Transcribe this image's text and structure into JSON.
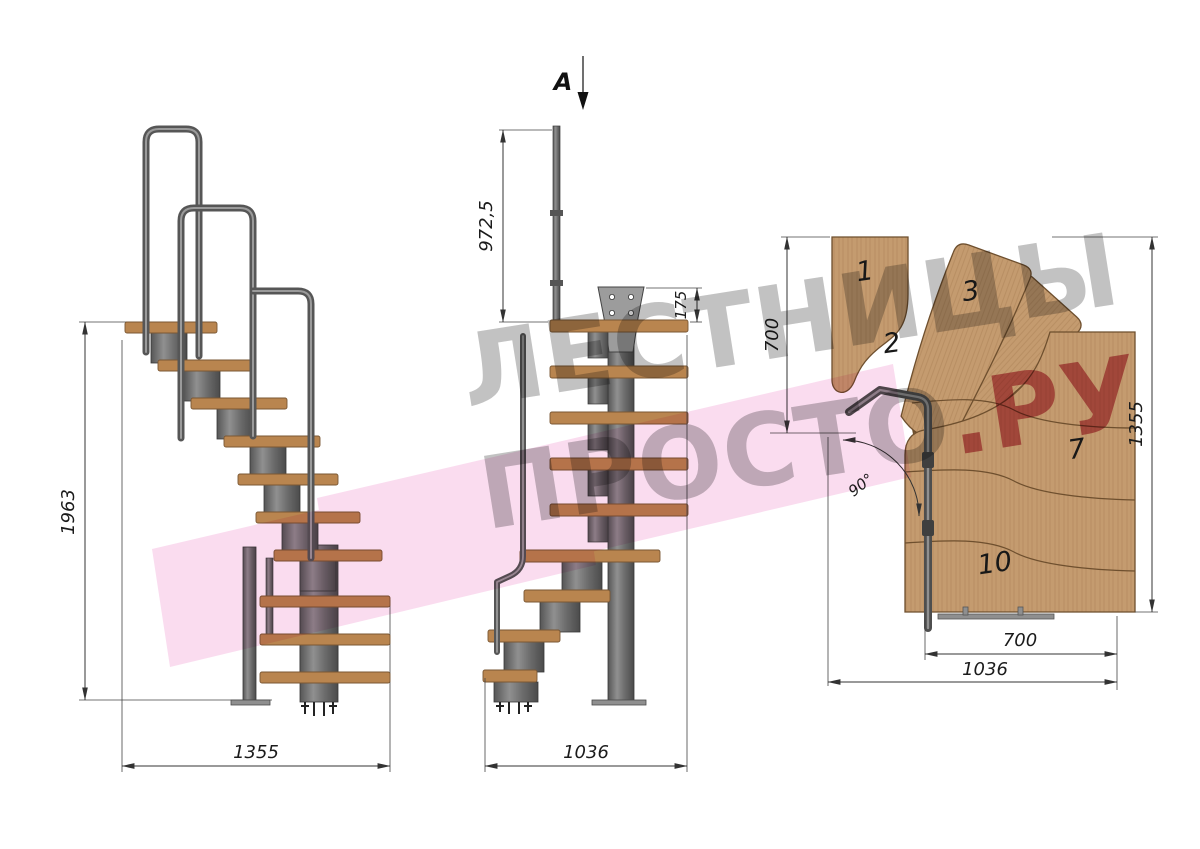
{
  "watermark": {
    "line1": "ЛЕСТНИЦЫ",
    "line2_gray": "ПРОСТО",
    "line2_red": ".РУ",
    "gray_color": "#ababab",
    "red_color": "#c13e54",
    "logo_pink": "#f6c0e2"
  },
  "section_marker": {
    "label": "A"
  },
  "views": {
    "side": {
      "title": "side-elevation",
      "dims": {
        "height": "1963",
        "width": "1355"
      }
    },
    "front": {
      "title": "front-elevation",
      "dims": {
        "pole_height": "972,5",
        "plate_height": "175",
        "width": "1036"
      }
    },
    "plan": {
      "title": "top-plan",
      "dims": {
        "left_height": "700",
        "right_height": "1355",
        "angle": "90°",
        "inner_width": "700",
        "outer_width": "1036"
      },
      "tread_labels": [
        "1",
        "2",
        "3",
        "7",
        "10"
      ]
    }
  },
  "colors": {
    "wood_elevation": "#b9854f",
    "wood_plan": "#c49b6f",
    "metal": "#6f6f6f",
    "metal_dark": "#474747",
    "dimension_line": "#333333",
    "dimension_text": "#1b1b1b",
    "background": "#ffffff"
  }
}
